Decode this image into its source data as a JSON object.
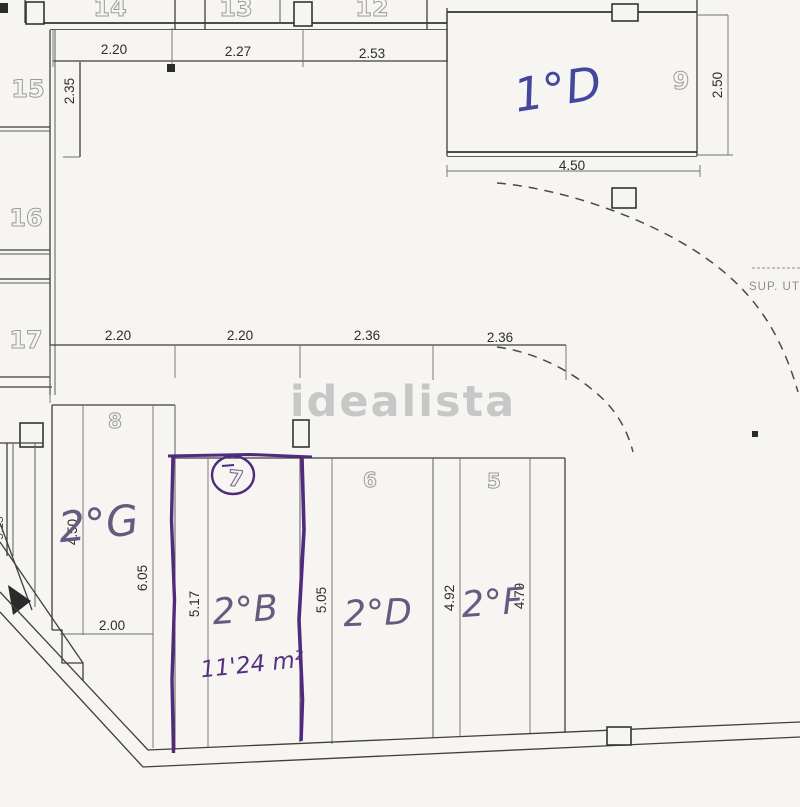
{
  "watermark": "idealista",
  "notes": {
    "sup_util": "SUP. UTIL",
    "area_note": "11'24 m²"
  },
  "units": {
    "n14": "14",
    "n13": "13",
    "n12": "12",
    "n15": "15",
    "n16": "16",
    "n17": "17",
    "n9": "9",
    "n8": "8",
    "n7": "7",
    "n6": "6",
    "n5": "5"
  },
  "handwritten": {
    "unit9": "1°D",
    "unit8": "2°G",
    "unit7": "2°B",
    "unit6": "2°D",
    "unit5": "2°F"
  },
  "dims": {
    "top1": "2.20",
    "top2": "2.27",
    "top3": "2.53",
    "left_v": "2.35",
    "u9_w": "4.50",
    "u9_h": "2.50",
    "mid1": "2.20",
    "mid2": "2.20",
    "mid3": "2.36",
    "mid4": "2.36",
    "u8_v1": "4.50",
    "u8_v2": "6.05",
    "u8_w": "2.00",
    "u7_v": "5.17",
    "u6_v": "5.05",
    "u5_v1": "4.92",
    "u5_v2": "4.79",
    "edge_v": "5.15"
  },
  "colors": {
    "paper": "#f7f5f1",
    "plan_line": "#3f3f3f",
    "outline_digit": "#9b9b9b",
    "watermark_gray": "#c7c7c7",
    "mark_purple": "#4f2a7e",
    "label_ink": "#665b7f",
    "blue_ink": "#4447a0"
  }
}
